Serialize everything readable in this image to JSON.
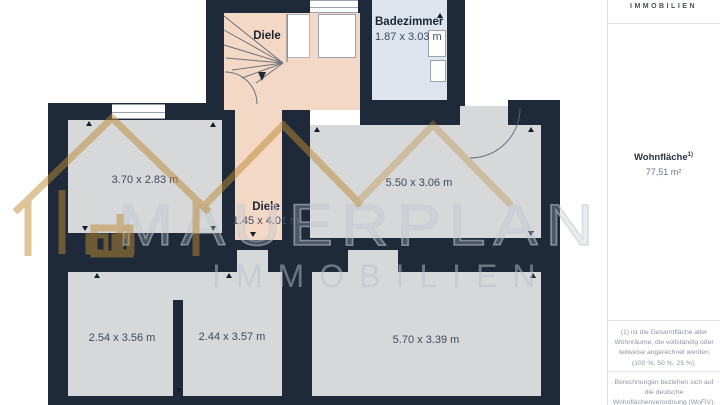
{
  "watermark": {
    "title": "MAUERPLAN",
    "subtitle": "IMMOBILIEN"
  },
  "rooms": {
    "stair_hall": {
      "label": "Diele"
    },
    "badezimmer": {
      "label": "Badezimmer",
      "dims": "1.87 x 3.03 m"
    },
    "room_top_left": {
      "dims": "3.70 x 2.83 m"
    },
    "diele_corridor": {
      "label": "Diele",
      "dims": "1.45 x 4.01 m"
    },
    "room_middle_right": {
      "dims": "5.50 x 3.06 m"
    },
    "room_bottom_left": {
      "dims": "2.54 x 3.56 m"
    },
    "room_bottom_middle": {
      "dims": "2.44 x 3.57 m"
    },
    "room_bottom_right": {
      "dims": "5.70 x 3.39 m"
    }
  },
  "sidebar": {
    "brand": "IMMOBILIEN",
    "area_label": "Wohnfläche",
    "area_superscript": "1)",
    "area_value": "77,51 m²",
    "footnote1": "(1) ist die Gesamtfläche aller Wohnräume, die vollständig oder teilweise angerechnet werden (100 %, 50 %, 25 %).",
    "footnote2": "Berechnungen beziehen sich auf die deutsche Wohnflächenverordnung (WoFlV). Maße sind ungefähre Angaben"
  },
  "colors": {
    "wall": "#1e2a3a",
    "room_grey": "#d6d8da",
    "room_pink": "#f3d8c6",
    "room_blue": "#dde4ee",
    "watermark_gold": "#c08a34"
  }
}
